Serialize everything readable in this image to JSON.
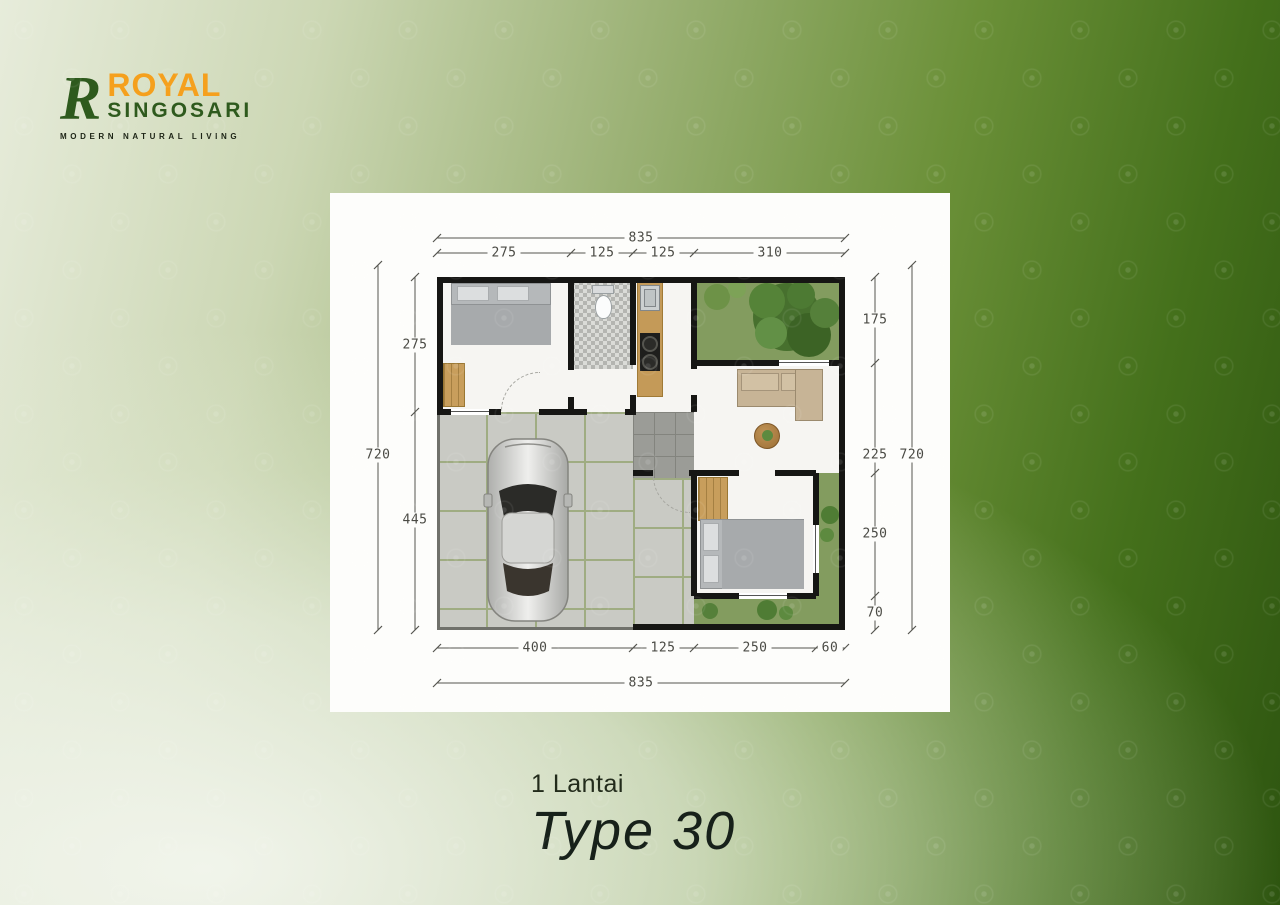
{
  "brand": {
    "monogram": "R",
    "name": "ROYAL",
    "name2": "SINGOSARI",
    "tagline": "MODERN NATURAL LIVING",
    "color_orange": "#F5A01D",
    "color_green": "#2E5A1D"
  },
  "caption": {
    "floors": "1 Lantai",
    "type": "Type 30"
  },
  "floorplan": {
    "top_total": "835",
    "top_segments": [
      "275",
      "125",
      "125",
      "310"
    ],
    "bottom_segments": [
      "400",
      "125",
      "250",
      "60"
    ],
    "bottom_total": "835",
    "left_outer_total": "720",
    "left_segments": [
      "275",
      "445"
    ],
    "right_segments": [
      "175",
      "225",
      "250",
      "70"
    ],
    "right_outer_total": "720"
  }
}
